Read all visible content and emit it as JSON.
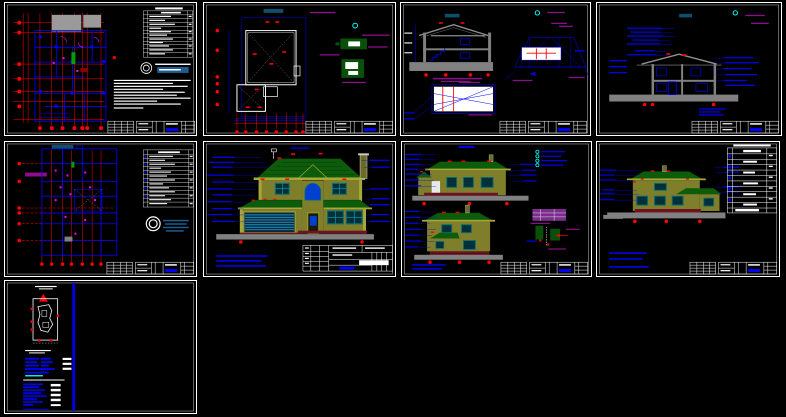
{
  "app": {
    "title": "CAD model space - residential house drawing set",
    "sheet_count": 9,
    "zoom_level": "fit-all"
  },
  "palette": {
    "bg": "#000000",
    "white": "#ffffff",
    "red": "#ff0000",
    "blue": "#0000ff",
    "cyan": "#00ffff",
    "magenta": "#ff00ff",
    "green": "#00a000",
    "roof": "#0c5c0c",
    "wall": "#7f7f2b",
    "trim": "#a8a838",
    "winframe": "#0e6b6b",
    "glass": "#013039",
    "glint": "#19b8d8",
    "gray": "#808080",
    "ltgray": "#c8c8c8",
    "brick": "#6e1322",
    "purple": "#8c0e8c",
    "steel": "#1d5d8f",
    "titlebar": "#0e4f6e",
    "dkred": "#8b0000"
  },
  "sheets": [
    {
      "id": "s1",
      "content": "First floor plan with red column grid, schedule table and notes"
    },
    {
      "id": "s2",
      "content": "Roof plan with dimension grid and two green details"
    },
    {
      "id": "s3",
      "content": "Building section and formwork details"
    },
    {
      "id": "s4",
      "content": "Annotated building cross-section"
    },
    {
      "id": "s5",
      "content": "Second floor plan with schedule table and revision cloud"
    },
    {
      "id": "s6",
      "content": "Main front elevation of two-story house"
    },
    {
      "id": "s7",
      "content": "Two side elevations with legend and detail"
    },
    {
      "id": "s8",
      "content": "Rear elevation with finish schedule table"
    },
    {
      "id": "s9",
      "content": "Site plan sheet with legend text blocks"
    }
  ]
}
